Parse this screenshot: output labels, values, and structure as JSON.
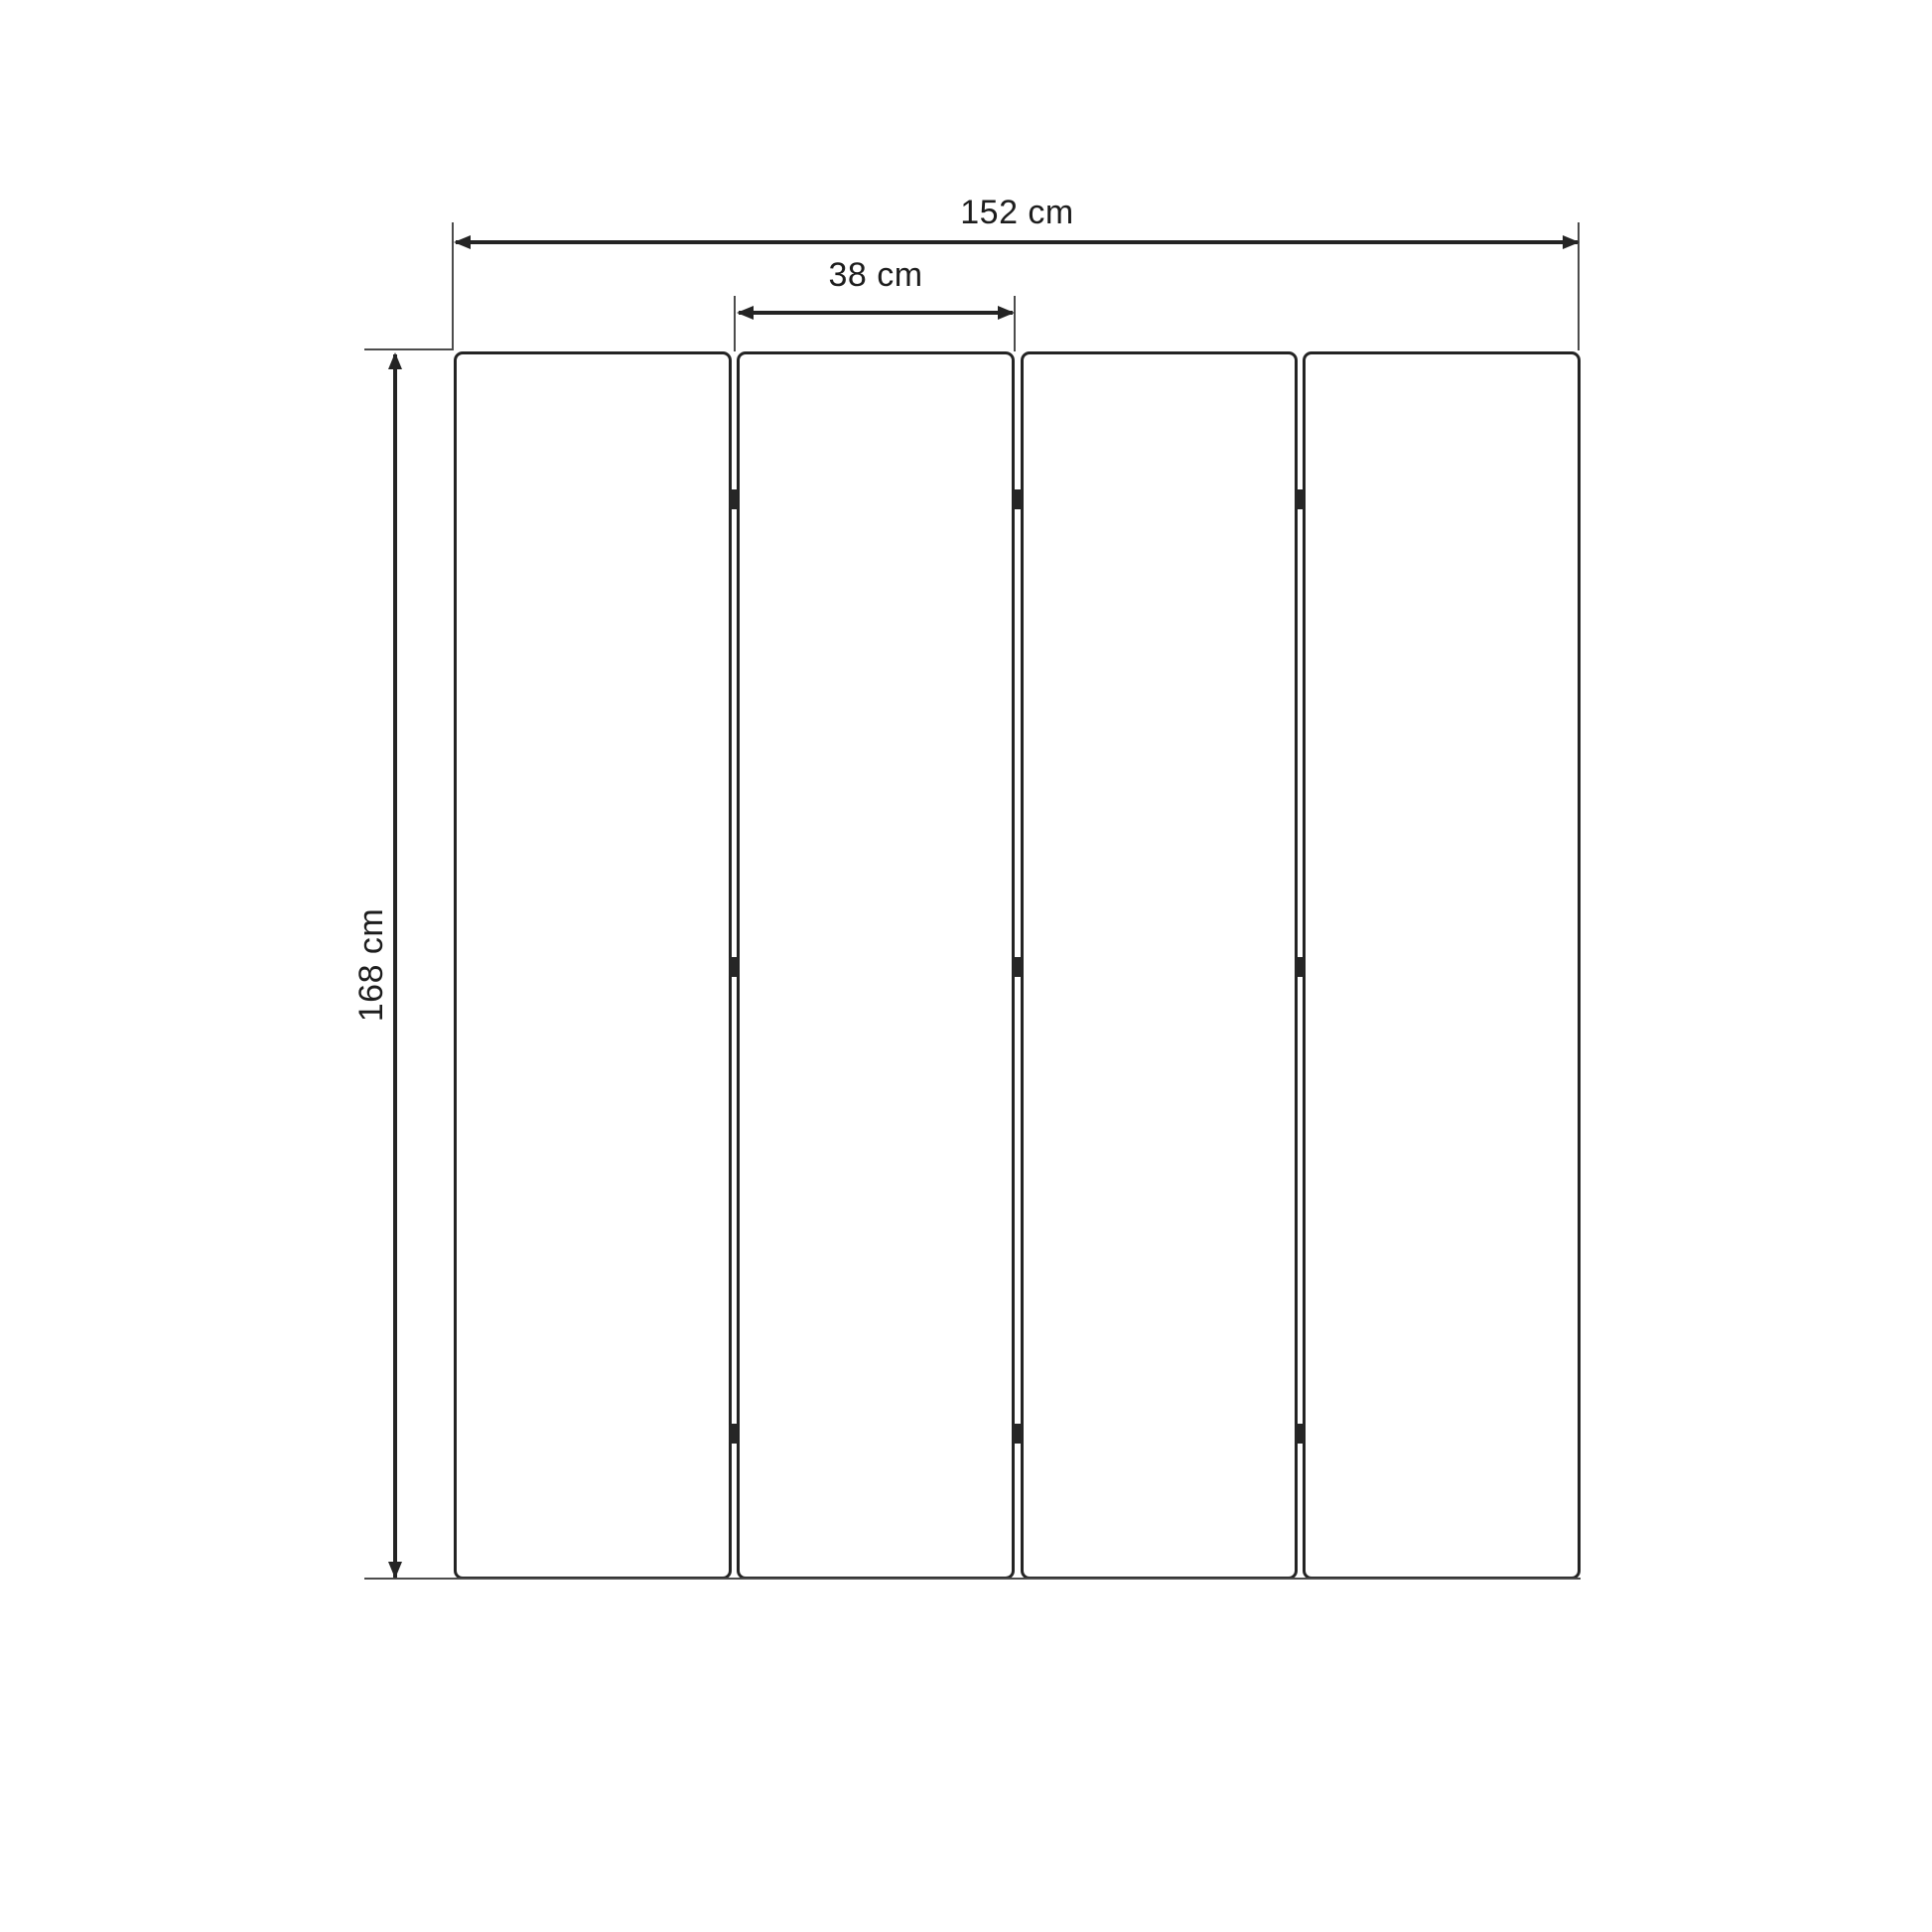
{
  "diagram": {
    "subject": "four-panel folding screen dimension drawing",
    "labels": {
      "total_width": "152 cm",
      "panel_width": "38 cm",
      "panel_height": "168 cm"
    },
    "dimensions": {
      "total_width_cm": 152,
      "panel_width_cm": 38,
      "height_cm": 168,
      "unit": "cm"
    },
    "structure": {
      "panel_count": 4,
      "hinge_rows": 3,
      "hinges_per_gap": 3
    },
    "colors": {
      "background": "#ffffff",
      "line": "#242424",
      "extension_line": "#4c4c4c",
      "text": "#1d1d1d"
    }
  }
}
